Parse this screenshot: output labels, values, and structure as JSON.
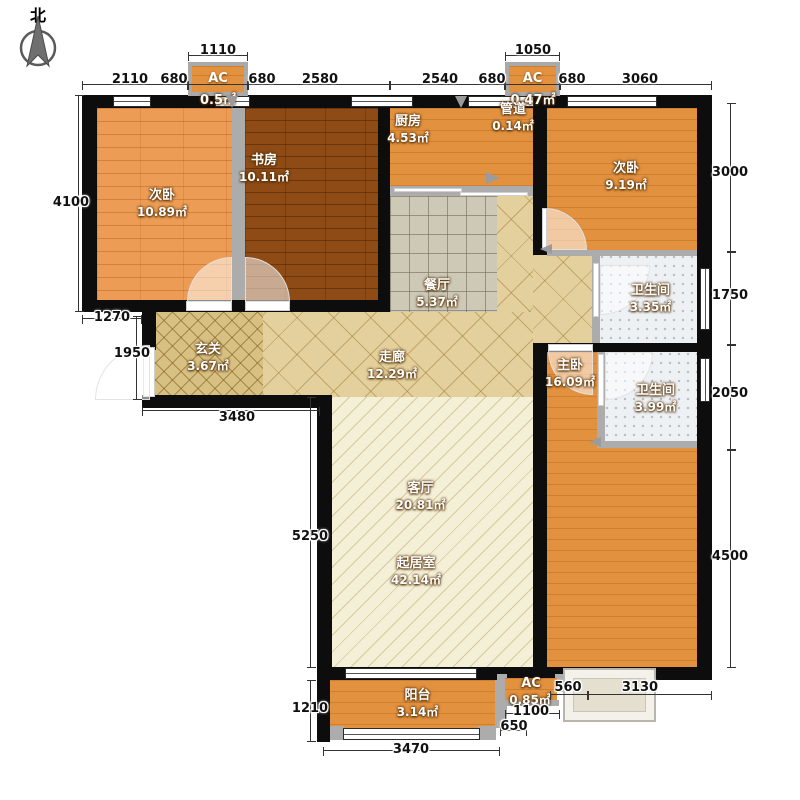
{
  "compass": {
    "label": "北"
  },
  "rooms": {
    "bedroom_left": {
      "name": "次卧",
      "area": "10.89㎡"
    },
    "study": {
      "name": "书房",
      "area": "10.11㎡"
    },
    "kitchen": {
      "name": "厨房",
      "area": "4.53㎡"
    },
    "duct": {
      "name": "管道",
      "area": "0.14㎡"
    },
    "bedroom_right": {
      "name": "次卧",
      "area": "9.19㎡"
    },
    "dining": {
      "name": "餐厅",
      "area": "5.37㎡"
    },
    "bathroom_top": {
      "name": "卫生间",
      "area": "3.35㎡"
    },
    "foyer": {
      "name": "玄关",
      "area": "3.67㎡"
    },
    "corridor": {
      "name": "走廊",
      "area": "12.29㎡"
    },
    "master_bedroom": {
      "name": "主卧",
      "area": "16.09㎡"
    },
    "bathroom_master": {
      "name": "卫生间",
      "area": "3.99㎡"
    },
    "living_room": {
      "name": "客厅",
      "area": "20.81㎡"
    },
    "living_area": {
      "name": "起居室",
      "area": "42.14㎡"
    },
    "balcony": {
      "name": "阳台",
      "area": "3.14㎡"
    },
    "ac_top_left": {
      "name": "AC",
      "area": "0.5㎡"
    },
    "ac_top_right": {
      "name": "AC",
      "area": "0.47㎡"
    },
    "ac_bottom": {
      "name": "AC",
      "area": "0.85㎡"
    }
  },
  "dimensions": {
    "top_outer": {
      "left": "1110",
      "right": "1050"
    },
    "top": {
      "d1": "2110",
      "d2": "680",
      "d3": "680",
      "d4": "2580",
      "d5": "2540",
      "d6": "680",
      "d7": "680",
      "d8": "3060"
    },
    "left": {
      "d1": "4100",
      "d2": "1270",
      "d3": "1950",
      "d4": "5250",
      "d5": "1210"
    },
    "right": {
      "d1": "3000",
      "d2": "1750",
      "d3": "2050",
      "d4": "4500"
    },
    "bottom": {
      "d1": "3480",
      "d2": "3470",
      "d3": "560",
      "d4": "3130",
      "d5": "650",
      "d6": "1100"
    }
  },
  "colors": {
    "wall": "#0d0d0d",
    "wood_light": "#ec9c54",
    "wood_dark": "#8e4b15",
    "wood_orange": "#e2913f",
    "tile_dining": "#cec8b7",
    "corridor_tan": "#e4d09c",
    "foyer_tan": "#d8bf82",
    "living_cream": "#f4efd7",
    "bath_grey": "#eef1f4",
    "fitting_grey": "#acacac"
  }
}
